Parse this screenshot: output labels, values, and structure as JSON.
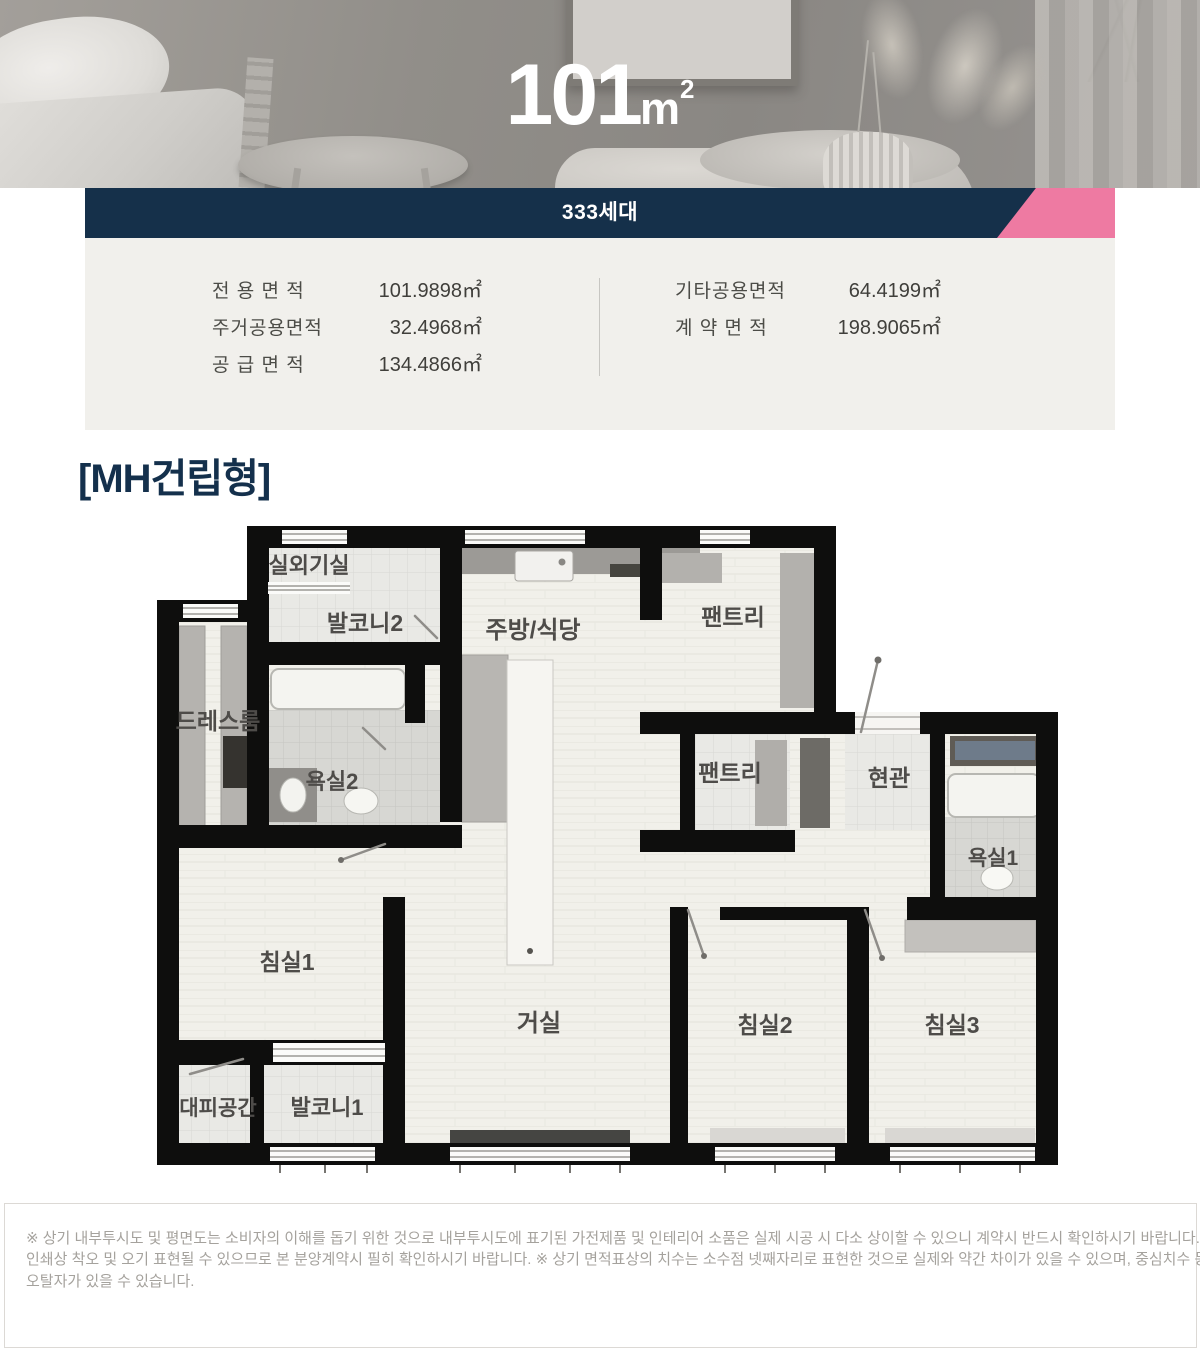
{
  "hero": {
    "area_number": "101",
    "area_unit": "m",
    "area_sup": "2"
  },
  "units_bar": {
    "label": "333세대"
  },
  "specs": {
    "left": [
      {
        "label": "전 용 면 적",
        "value": "101.9898㎡"
      },
      {
        "label": "주거공용면적",
        "value": "32.4968㎡"
      },
      {
        "label": "공 급 면 적",
        "value": "134.4866㎡"
      }
    ],
    "right": [
      {
        "label": "기타공용면적",
        "value": "64.4199㎡"
      },
      {
        "label": "계 약 면 적",
        "value": "198.9065㎡"
      }
    ]
  },
  "plan": {
    "type_label": "[MH건립형]",
    "rooms": [
      {
        "label": "실외기실"
      },
      {
        "label": "발코니2"
      },
      {
        "label": "주방/식당"
      },
      {
        "label": "팬트리"
      },
      {
        "label": "드레스룸"
      },
      {
        "label": "욕실2"
      },
      {
        "label": "팬트리"
      },
      {
        "label": "현관"
      },
      {
        "label": "욕실1"
      },
      {
        "label": "침실1"
      },
      {
        "label": "거실"
      },
      {
        "label": "침실2"
      },
      {
        "label": "침실3"
      },
      {
        "label": "대피공간"
      },
      {
        "label": "발코니1"
      }
    ]
  },
  "disclaimer": {
    "lines": [
      "※ 상기 내부투시도 및 평면도는 소비자의 이해를 돕기 위한 것으로 내부투시도에 표기된 가전제품 및 인테리어 소품은 실제 시공 시 다소 상이할 수 있으니 계약시 반드시 확인하시기 바랍니다. ※ 상기 평면도 면적은",
      "인쇄상 착오 및 오기 표현될 수 있으므로 본 분양계약시 필히 확인하시기 바랍니다. ※ 상기 면적표상의 치수는 소수점 넷째자리로 표현한 것으로 실제와 약간 차이가 있을 수 있으며, 중심치수 등이 편집상의 오류로",
      "오탈자가 있을 수 있습니다."
    ]
  },
  "colors": {
    "navy": "#15304a",
    "pink": "#ee7aa2",
    "panel_bg": "#f1f0ec"
  }
}
